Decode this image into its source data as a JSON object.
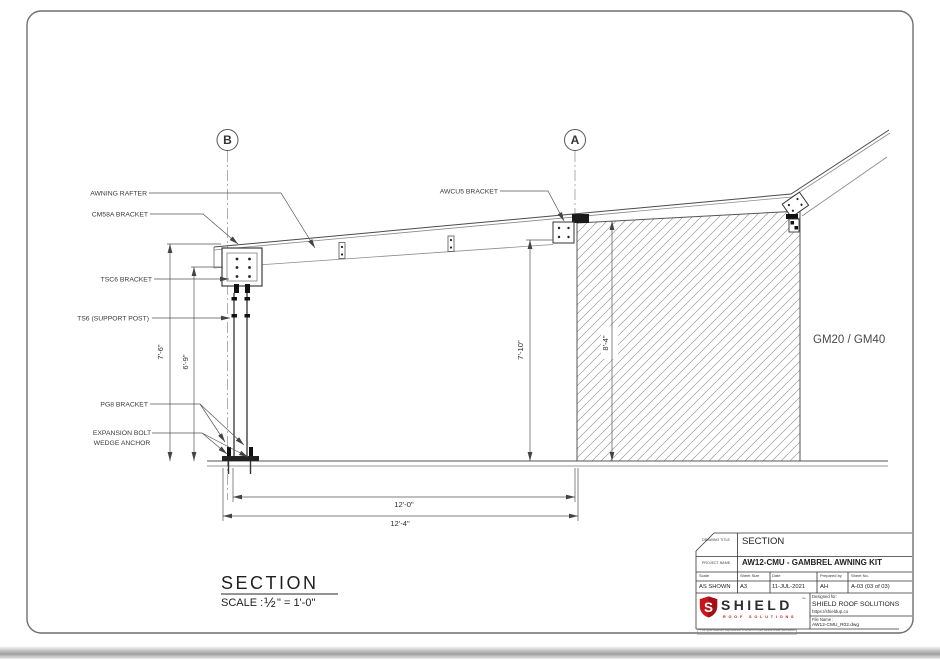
{
  "page": {
    "markers": {
      "b": "B",
      "a": "A"
    },
    "labels": {
      "awning_rafter": "AWNING RAFTER",
      "cm58a": "CM58A BRACKET",
      "tsc6": "TSC6 BRACKET",
      "ts6": "TS6 (SUPPORT POST)",
      "pg8": "PG8 BRACKET",
      "expansion1": "EXPANSION BOLT",
      "expansion2": "WEDGE ANCHOR",
      "awcu5": "AWCU5 BRACKET",
      "gm": "GM20 / GM40"
    },
    "dimensions": {
      "h1": "7'-6\"",
      "h2": "6'-9\"",
      "h3": "7'-10\"",
      "h4": "8'-4\"",
      "w1": "12'-0\"",
      "w2": "12'-4\""
    },
    "view_title": {
      "text": "SECTION",
      "scale_prefix": "SCALE : ",
      "scale_fraction": "½",
      "scale_suffix": "\" = 1'-0\""
    },
    "title_block": {
      "drawing_title_label": "DRAWING TITLE",
      "drawing_title": "SECTION",
      "project_name_label": "PROJECT NAME",
      "project_name": "AW12-CMU - GAMBREL AWNING KIT",
      "fields": [
        {
          "label": "Scale",
          "value": "AS SHOWN"
        },
        {
          "label": "Sheet Size",
          "value": "A3"
        },
        {
          "label": "Date",
          "value": "11-JUL-2021"
        },
        {
          "label": "Prepared by",
          "value": "AH"
        },
        {
          "label": "Sheet No.",
          "value": "A-03 (03 of 03)"
        }
      ],
      "designed_for_label": "Designed for:",
      "designed_for": "SHIELD ROOF SOLUTIONS",
      "designed_for_url": "https://shieldup.co",
      "file_name_label": "File Name :",
      "file_name": "AW12-CMU_R02.dwg",
      "logo": {
        "brand": "SHIELD",
        "tm": "™",
        "tagline": "ROOF SOLUTIONS",
        "red": "#c4161c",
        "letter": "S"
      },
      "copyright": "© All rights reserved. Reproduction in whole or in part without written permission is prohibited."
    }
  }
}
